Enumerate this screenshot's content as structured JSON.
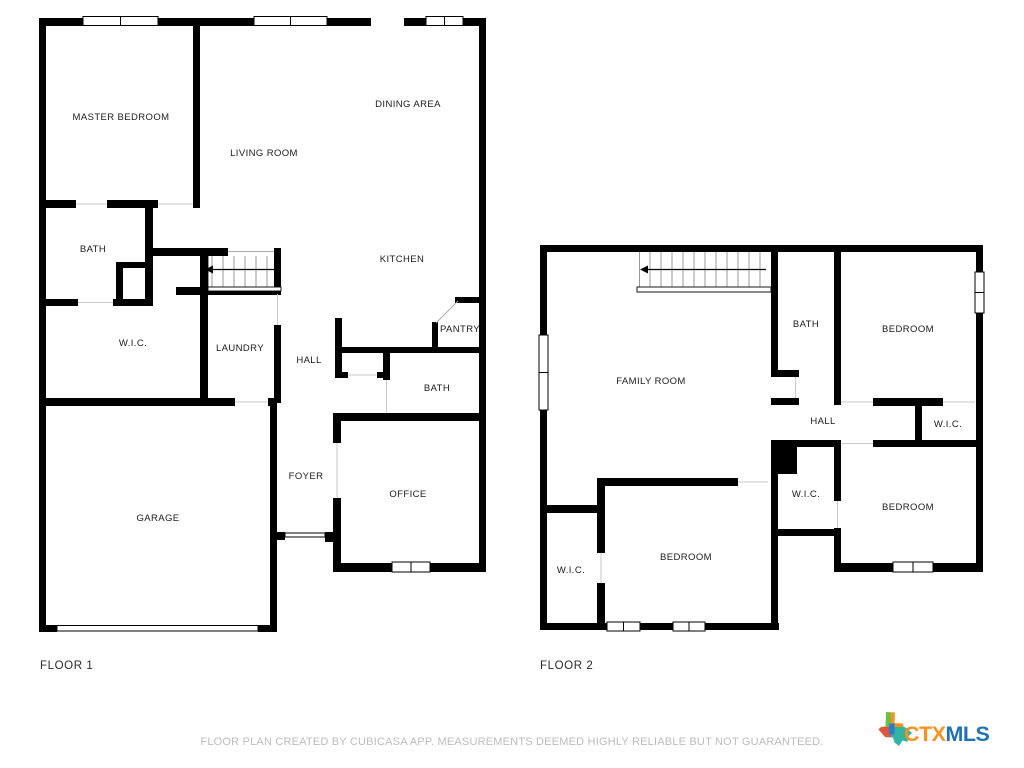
{
  "floor1": {
    "label": "FLOOR 1",
    "rooms": {
      "master_bedroom": "MASTER BEDROOM",
      "living_room": "LIVING ROOM",
      "dining_area": "DINING AREA",
      "bath": "BATH",
      "kitchen": "KITCHEN",
      "wic": "W.I.C.",
      "laundry": "LAUNDRY",
      "hall": "HALL",
      "pantry": "PANTRY",
      "bath2": "BATH",
      "foyer": "FOYER",
      "office": "OFFICE",
      "garage": "GARAGE"
    }
  },
  "floor2": {
    "label": "FLOOR 2",
    "rooms": {
      "family_room": "FAMILY ROOM",
      "bath": "BATH",
      "bedroom_top_right": "BEDROOM",
      "hall": "HALL",
      "wic_top_right": "W.I.C.",
      "wic_middle": "W.I.C.",
      "bedroom_bottom_right": "BEDROOM",
      "bedroom_bottom_middle": "BEDROOM",
      "wic_bottom_left": "W.I.C."
    }
  },
  "footer": {
    "disclaimer": "FLOOR PLAN CREATED BY CUBICASA APP. MEASUREMENTS DEEMED HIGHLY RELIABLE BUT NOT GUARANTEED."
  },
  "logo": {
    "text_ctx": "CTX",
    "text_mls": "MLS",
    "ctx_color": "#F6921E",
    "mls_color": "#1F72B8",
    "texas_green": "#6FBE4A",
    "texas_orange": "#F6921E",
    "texas_red": "#E2533C",
    "texas_teal": "#2FB4A5",
    "texas_blue": "#2E7CC3"
  }
}
